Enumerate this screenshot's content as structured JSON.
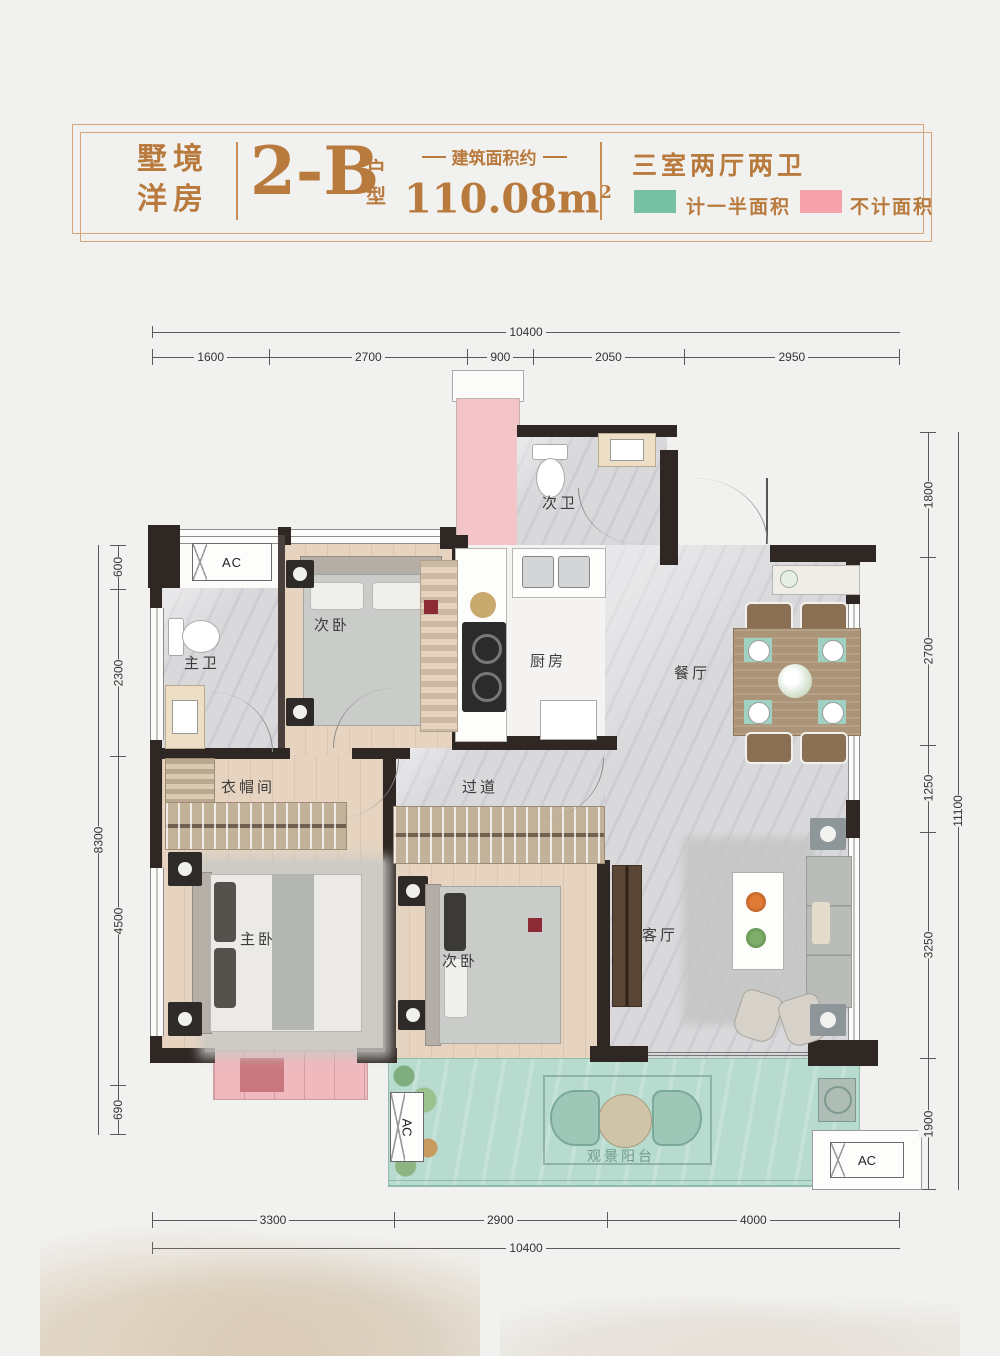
{
  "header": {
    "series_line1": "墅境",
    "series_line2": "洋房",
    "unit_code": "2-B",
    "unit_suffix_top": "户",
    "unit_suffix_bottom": "型",
    "area_label": "建筑面积约",
    "area_value": "110.08m",
    "area_superscript": "2",
    "layout_summary": "三室两厅两卫",
    "legend": [
      {
        "label": "计一半面积",
        "color": "#76c0a5"
      },
      {
        "label": "不计面积",
        "color": "#f5a2ab"
      }
    ]
  },
  "dimensions": {
    "top_total": "10400",
    "top_segments": [
      "1600",
      "2700",
      "900",
      "2050",
      "2950"
    ],
    "left_total": "8300",
    "left_segments": [
      "600",
      "2300",
      "4500",
      "690"
    ],
    "right_total": "11100",
    "right_segments": [
      "1800",
      "2700",
      "1250",
      "3250",
      "1900"
    ],
    "bottom_total": "10400",
    "bottom_segments": [
      "3300",
      "2900",
      "4000"
    ]
  },
  "rooms": {
    "secondary_bath": "次卫",
    "master_bath": "主卫",
    "bedroom_top": "次卧",
    "kitchen": "厨房",
    "dining": "餐厅",
    "cloakroom": "衣帽间",
    "hallway": "过道",
    "master_bedroom": "主卧",
    "bedroom_bottom": "次卧",
    "living": "客厅",
    "balcony": "观景阳台"
  },
  "labels": {
    "ac": "AC"
  },
  "colors": {
    "accent_text": "#b97a3e",
    "wall": "#2f2723",
    "half_area_fill": "#b7dbce",
    "excluded_fill": "#f4c5c8"
  }
}
